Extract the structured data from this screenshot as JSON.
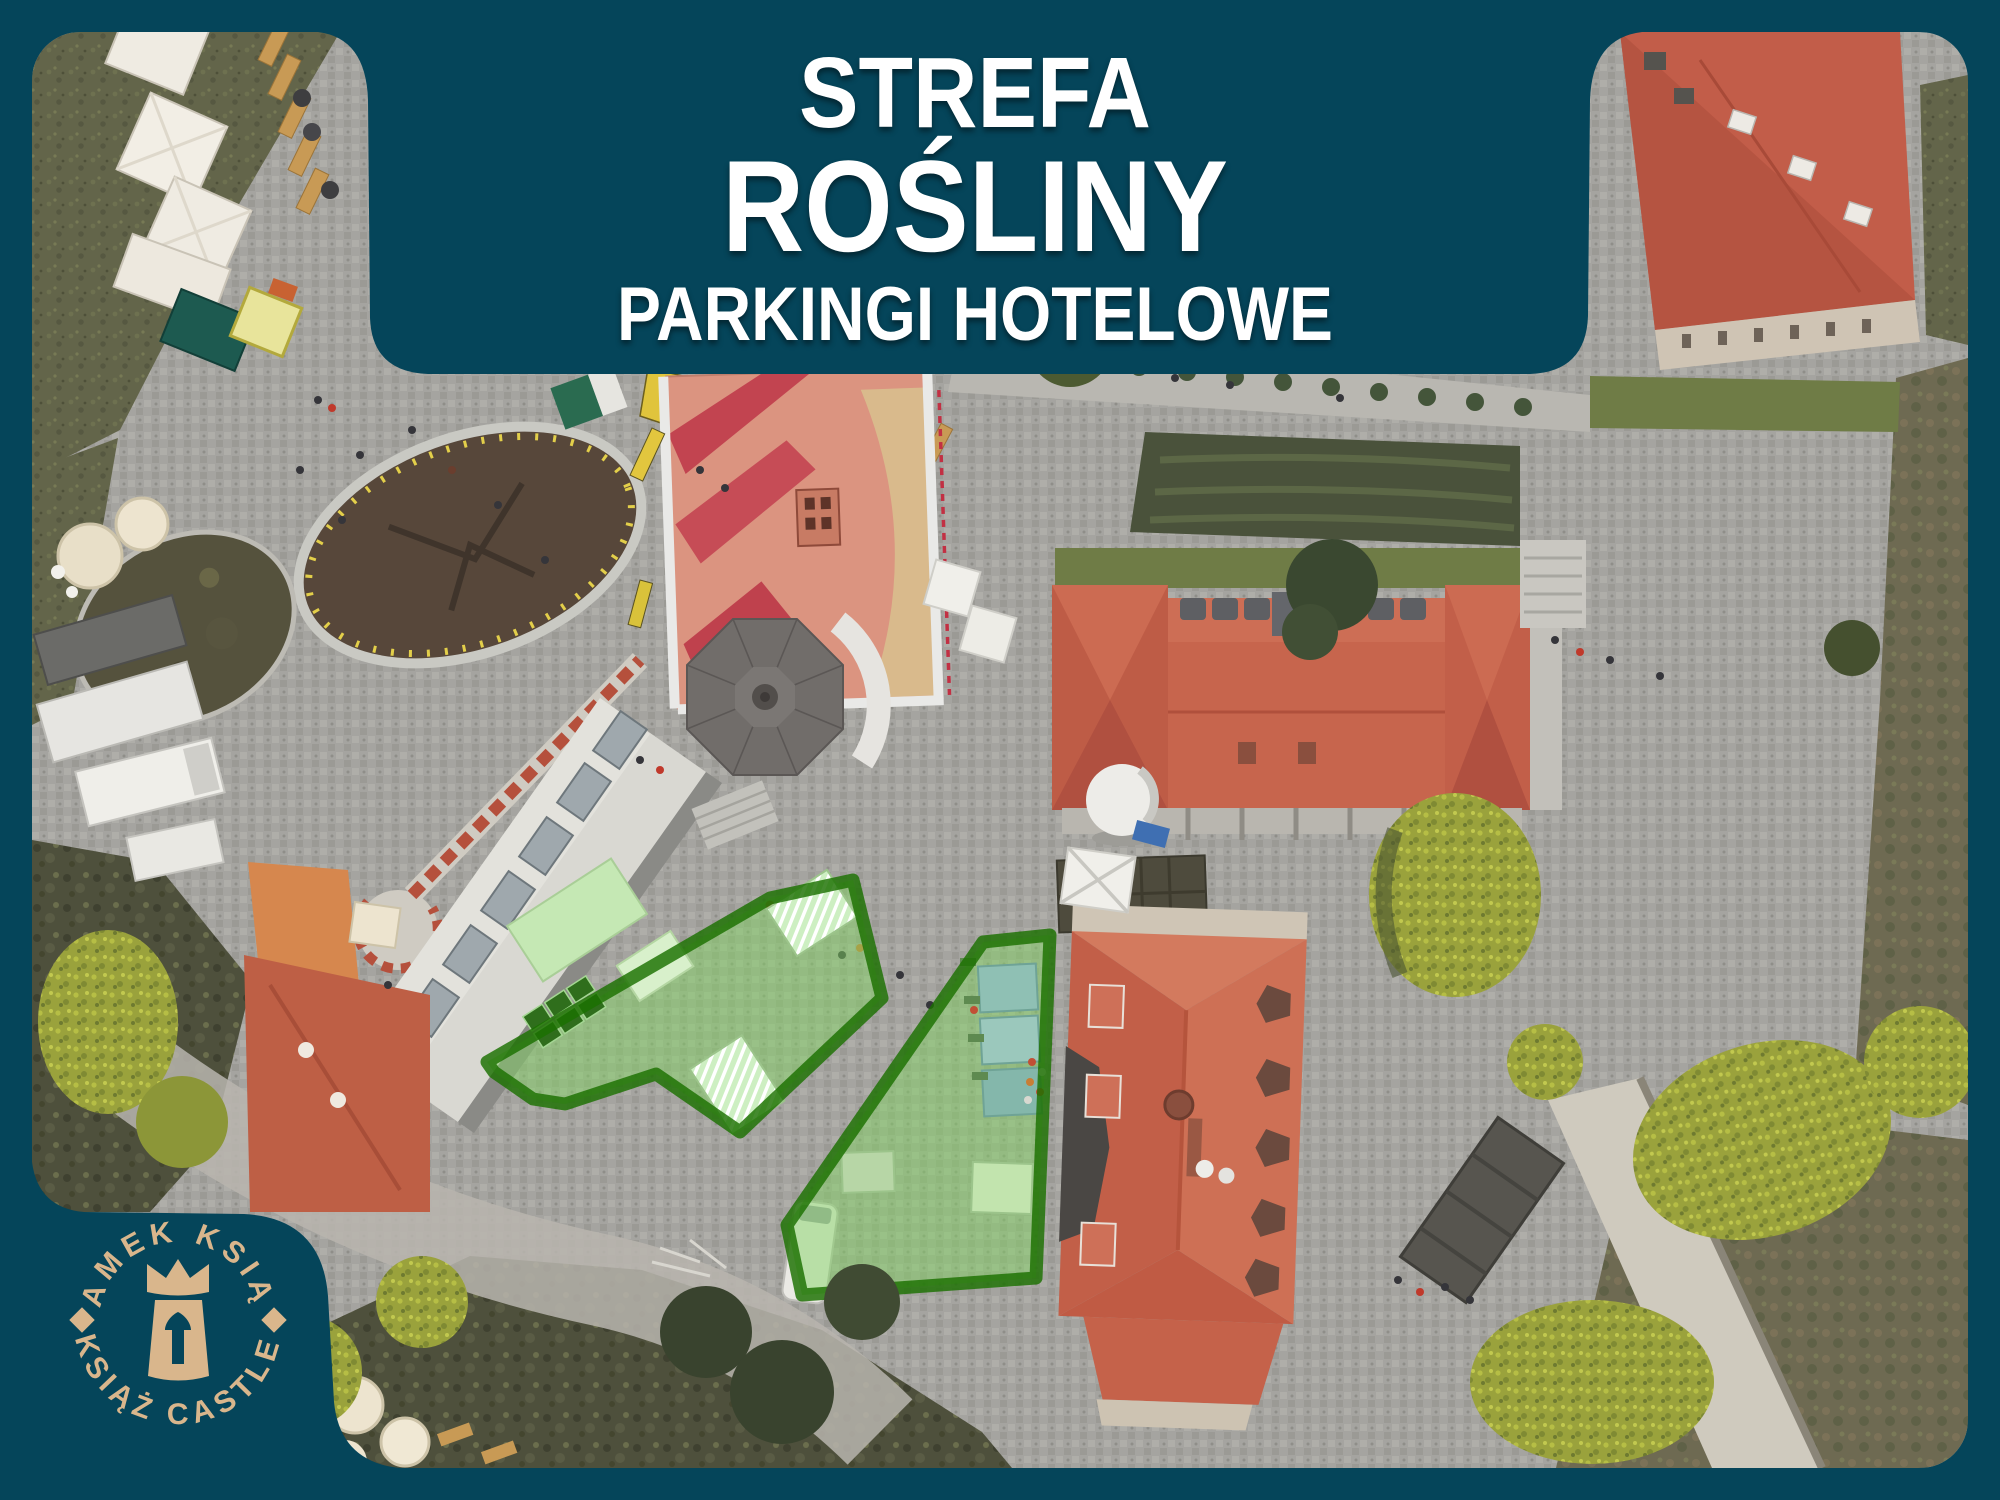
{
  "banner": {
    "title_line1": "STREFA",
    "title_line2": "ROŚLINY",
    "title_line3": "PARKINGI HOTELOWE",
    "background_color": "#05455A",
    "text_color": "#FFFFFF"
  },
  "logo": {
    "arc_top": "ZAMEK KSIĄŻ",
    "arc_bottom": "KSIĄŻ CASTLE",
    "color": "#D9B68C",
    "icon": "castle-tower-crown-keyhole-icon"
  },
  "map": {
    "kind": "aerial-drone-photo",
    "subject": "Książ Castle courtyards with highlighted plant-sale / hotel-parking zones",
    "highlight_zones": [
      {
        "id": "zone-west",
        "fill": "#81D662",
        "fill_opacity": 0.48,
        "border": "#1B7000"
      },
      {
        "id": "zone-east",
        "fill": "#81D662",
        "fill_opacity": 0.48,
        "border": "#1B7000"
      }
    ],
    "frame_color": "#05455A"
  }
}
